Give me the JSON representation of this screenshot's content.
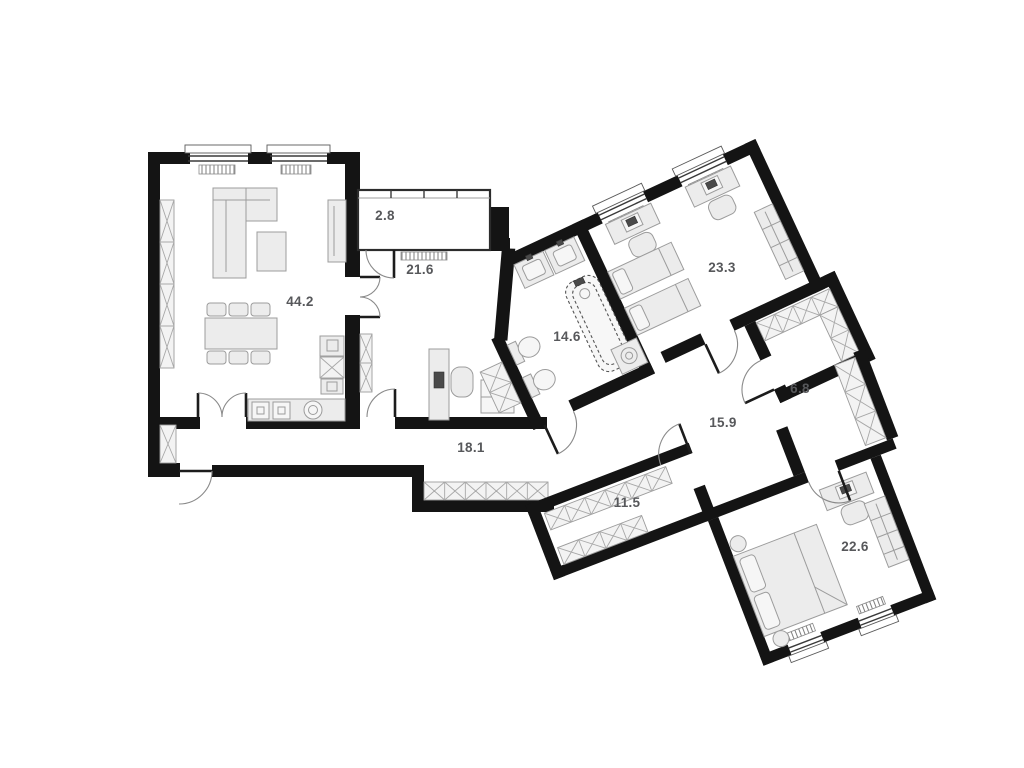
{
  "plan": {
    "rooms": {
      "living": {
        "area": "44.2"
      },
      "balcony": {
        "area": "2.8"
      },
      "study": {
        "area": "21.6"
      },
      "bathroom": {
        "area": "14.6"
      },
      "kids_bedroom": {
        "area": "23.3"
      },
      "closet": {
        "area": "6.8"
      },
      "inner_hall": {
        "area": "15.9"
      },
      "entrance_hall": {
        "area": "18.1"
      },
      "wardrobe_corridor": {
        "area": "11.5"
      },
      "master_bedroom": {
        "area": "22.6"
      }
    },
    "colors": {
      "walls": "#141414",
      "furniture_fill": "#ececec",
      "furniture_stroke": "#9c9c9c",
      "label_text": "#57585b",
      "background": "#ffffff"
    }
  }
}
